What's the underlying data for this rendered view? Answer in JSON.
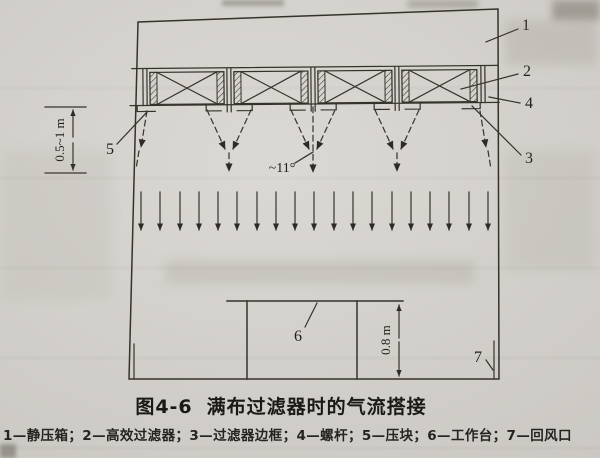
{
  "page": {
    "background": "#d2cfc9",
    "ink": "#35322c"
  },
  "caption": {
    "figure_no": "图4-6",
    "title": "满布过滤器时的气流搭接"
  },
  "legend_text": "1—静压箱；2—高效过滤器；3—过滤器边框；4—螺杆；5—压块；6—工作台；7—回风口",
  "callouts": [
    {
      "num": "1",
      "term": "静压箱"
    },
    {
      "num": "2",
      "term": "高效过滤器"
    },
    {
      "num": "3",
      "term": "过滤器边框"
    },
    {
      "num": "4",
      "term": "螺杆"
    },
    {
      "num": "5",
      "term": "压块"
    },
    {
      "num": "6",
      "term": "工作台"
    },
    {
      "num": "7",
      "term": "回风口"
    }
  ],
  "dimensions": {
    "filter_to_merge_distance": "0.5~1 m",
    "workbench_height": "0.8 m",
    "jet_spread_angle": "~11°"
  }
}
